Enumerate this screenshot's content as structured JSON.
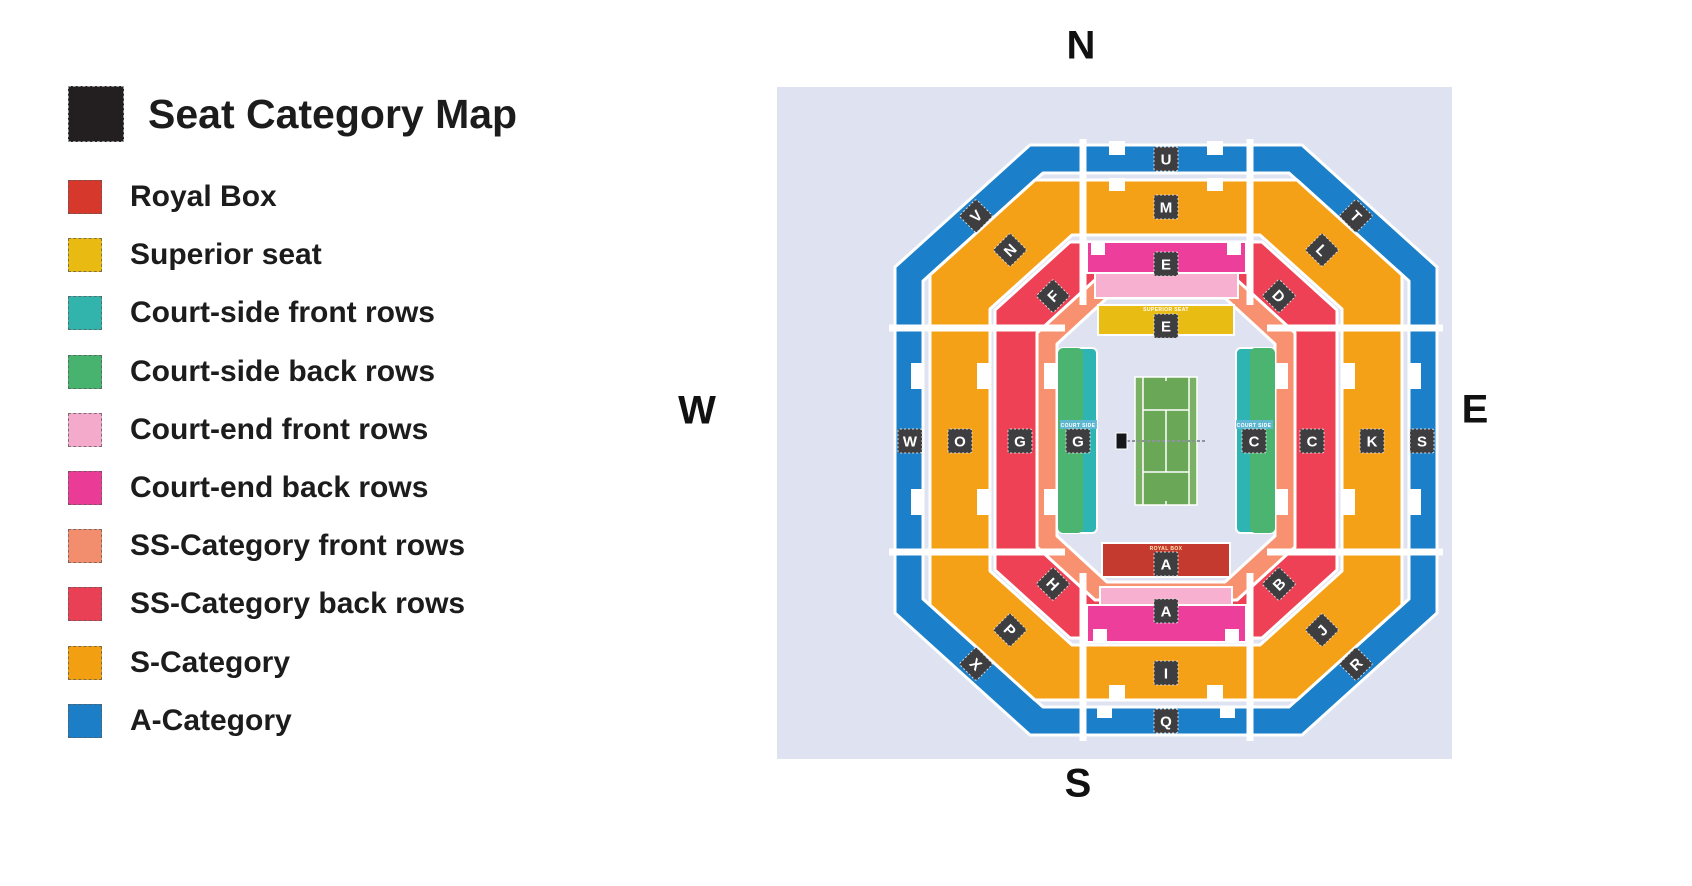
{
  "legend": {
    "title": "Seat Category Map",
    "title_swatch_color": "#231f20",
    "items": [
      {
        "label": "Royal Box",
        "color": "#d6392c"
      },
      {
        "label": "Superior seat",
        "color": "#e9ba12"
      },
      {
        "label": "Court-side front rows",
        "color": "#32b4ad"
      },
      {
        "label": "Court-side back rows",
        "color": "#47b36e"
      },
      {
        "label": "Court-end front rows",
        "color": "#f4aacb"
      },
      {
        "label": "Court-end back rows",
        "color": "#ea3c96"
      },
      {
        "label": "SS-Category front rows",
        "color": "#f28e6d"
      },
      {
        "label": "SS-Category back rows",
        "color": "#e94056"
      },
      {
        "label": "S-Category",
        "color": "#f2a011"
      },
      {
        "label": "A-Category",
        "color": "#1b7ec6"
      }
    ]
  },
  "compass": {
    "north": "N",
    "south": "S",
    "east": "E",
    "west": "W"
  },
  "map": {
    "colors": {
      "background": "#dfe3f1",
      "a_category": "#1b7fc9",
      "s_category": "#f5a118",
      "ss_back": "#ee4156",
      "ss_front": "#f7916f",
      "court_end_back": "#ee3e9c",
      "court_end_front": "#f8b0d0",
      "superior_seat": "#e9bc13",
      "royal_box": "#c43a2e",
      "court_side_front": "#2fb4b4",
      "court_side_back": "#4cb471",
      "court": "#6aa757",
      "court_alley": "#7bb164",
      "court_side_tag": "#62b8d8"
    },
    "stadium_labels": {
      "u": "U",
      "v": "V",
      "t": "T",
      "m": "M",
      "n": "N",
      "l": "L",
      "f": "F",
      "d": "D",
      "e_court_end": "E",
      "e_superior": "E",
      "w": "W",
      "o": "O",
      "g_ss": "G",
      "g_court_side": "G",
      "c_court_side": "C",
      "c_ss": "C",
      "k": "K",
      "s": "S",
      "a_royal": "A",
      "a_court_end": "A",
      "h": "H",
      "b": "B",
      "p": "P",
      "j": "J",
      "x": "X",
      "r": "R",
      "i": "I",
      "q": "Q"
    },
    "annotations": {
      "royal_box": "ROYAL BOX",
      "superior_seat": "SUPERIOR SEAT",
      "court_side": "COURT SIDE"
    }
  }
}
